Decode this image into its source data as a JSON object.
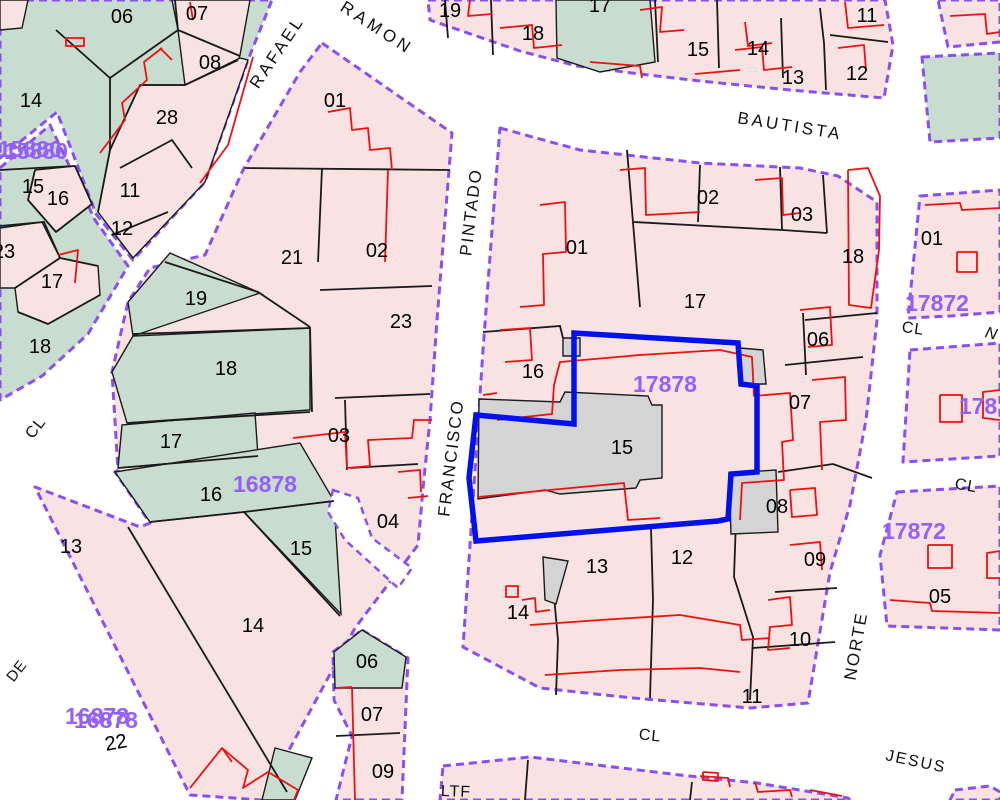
{
  "map": {
    "width": 1000,
    "height": 800,
    "colors": {
      "pink": "#f8e2e2",
      "green": "#c9dcd0",
      "gray": "#d4d4d4",
      "street": "#ffffff",
      "purple": "#8a50ee",
      "label_purple": "#9460fa",
      "red": "#f01010",
      "blue": "#0010ee",
      "black": "#1a1a1a",
      "text": "#000000"
    },
    "blocks": [
      {
        "name": "top-left",
        "fill": "green",
        "pts": "0,0 272,0 248,60 205,182 133,260 96,214 57,112 0,158"
      },
      {
        "name": "left-wedge",
        "fill": "green",
        "pts": "0,168 50,125 95,220 128,266 88,334 42,376 0,400"
      },
      {
        "name": "mega-16878",
        "fill": "pink",
        "pts": "322,43 452,133 445,220 437,320 430,420 424,478 418,545 355,628 262,800 190,795 35,487 140,527 150,523 115,472 118,470 112,372 128,302 150,268 205,255 243,170 300,72"
      },
      {
        "name": "se-strip",
        "fill": "pink",
        "pts": "362,630 408,658 402,800 336,800 352,736 334,700 333,652"
      },
      {
        "name": "central-17878",
        "fill": "pink",
        "pts": "500,128 580,150 700,163 800,168 838,176 877,202 877,320 866,420 850,505 830,572 808,703 750,708 633,698 540,688 463,647 469,560 475,470 483,350 492,230"
      },
      {
        "name": "top-strip",
        "fill": "pink",
        "pts": "428,0 885,0 893,45 884,98 790,90 700,81 640,74 577,66 520,51 430,20"
      },
      {
        "name": "top-right-1",
        "fill": "pink",
        "pts": "938,0 1000,0 1000,42 948,47"
      },
      {
        "name": "top-right-green",
        "fill": "green",
        "pts": "922,57 1000,53 1000,138 930,142"
      },
      {
        "name": "right-mid",
        "fill": "pink",
        "pts": "920,196 1000,190 1000,312 950,316 908,318"
      },
      {
        "name": "right-2",
        "fill": "pink",
        "pts": "910,350 1000,343 1000,456 903,462"
      },
      {
        "name": "right-3",
        "fill": "pink",
        "pts": "897,492 1000,486 1000,630 887,626 880,555"
      },
      {
        "name": "bottom-strip",
        "fill": "pink",
        "pts": "443,766 530,757 680,775 757,783 848,798 850,800 440,800"
      },
      {
        "name": "bottom-right-corner",
        "fill": "pink",
        "pts": "955,790 990,786 1000,792 1000,800 950,800"
      }
    ],
    "green_areas": [
      {
        "name": "strip-17",
        "pts": "556,0 650,0 655,62 600,72 557,58"
      },
      {
        "name": "mega-19",
        "pts": "128,302 170,253 260,293 133,336"
      },
      {
        "name": "mega-18",
        "pts": "112,372 133,336 310,328 310,410 127,423"
      },
      {
        "name": "mega-17",
        "pts": "118,468 122,425 255,413 258,456"
      },
      {
        "name": "mega-16",
        "pts": "115,472 300,443 334,501 244,512 150,522"
      },
      {
        "name": "mega-15",
        "pts": "244,512 334,501 341,614"
      },
      {
        "name": "se-06",
        "pts": "334,652 362,630 406,657 402,688 335,688"
      },
      {
        "name": "mega-sliver",
        "pts": "275,748 312,758 295,800 262,800"
      }
    ],
    "pink_areas": [
      {
        "name": "tl-07-08",
        "pts": "172,0 250,0 240,55 228,93 185,85 178,30"
      },
      {
        "name": "tl-28-11-12",
        "pts": "110,150 140,85 185,85 240,58 248,60 205,182 133,258 98,212"
      },
      {
        "name": "tl-corner",
        "pts": "0,0 28,0 22,28 0,30"
      },
      {
        "name": "lw-16",
        "pts": "35,170 75,166 92,204 56,232 28,200"
      },
      {
        "name": "lw-23",
        "pts": "0,228 42,222 60,258 15,288 0,288"
      },
      {
        "name": "lw-17",
        "pts": "15,288 60,258 98,266 100,295 48,324 18,312"
      }
    ],
    "white_notches": [
      {
        "name": "notch-04",
        "pts": "333,490 358,498 372,538 412,568 398,588 345,540 328,512"
      }
    ],
    "gray_buildings": [
      {
        "name": "bld-15",
        "pts": "479,399 560,402 565,392 648,396 652,405 662,405 662,478 640,480 636,488 560,494 545,490 478,499"
      },
      {
        "name": "bld-small-16",
        "pts": "563,338 580,338 580,356 563,356"
      },
      {
        "name": "bld-ne",
        "pts": "740,348 763,350 766,384 741,384"
      },
      {
        "name": "bld-08",
        "pts": "729,473 776,470 778,532 731,534"
      },
      {
        "name": "bld-13",
        "pts": "543,557 568,561 556,604 545,600"
      }
    ],
    "blue_parcel": "476,415 574,424 574,333 738,343 741,384 757,386 757,472 731,474 728,519 718,521 476,541 469,478",
    "black_lines": [
      "175,0 178,30",
      "56,30 110,78 178,30",
      "110,78 110,150 98,212",
      "178,30 240,56",
      "185,85 238,60",
      "140,85 185,85",
      "110,150 140,85",
      "120,168 172,140 192,168",
      "112,235 168,212",
      "0,170 36,168 75,166",
      "35,170 28,200 56,232",
      "56,232 92,204 75,166",
      "0,226 44,222 60,258",
      "15,288 60,258 98,266",
      "18,312 48,324 100,295",
      "245,168 450,170",
      "322,168 318,262",
      "165,262 258,292 310,327",
      "133,334 310,328",
      "127,423 310,412",
      "118,468 258,456",
      "150,522 244,512 334,501",
      "244,512 340,616",
      "128,527 287,792",
      "320,290 432,286",
      "310,327 312,412",
      "335,398 430,394",
      "345,400 347,470",
      "350,468 418,464",
      "483,332 560,326 563,338",
      "627,150 640,307",
      "634,222 782,230 827,233",
      "780,167 782,230",
      "823,175 827,233",
      "805,320 877,313",
      "803,313 806,375",
      "785,365 863,357",
      "778,472 833,464 872,478",
      "775,592 837,588",
      "736,520 734,577 753,637 750,700",
      "651,528 653,600 650,698",
      "553,585 558,640 556,695",
      "753,648 835,642",
      "700,165 698,222",
      "336,736 400,733",
      "445,0 448,38",
      "491,0 493,55",
      "717,0 719,68",
      "781,18 783,78",
      "820,8 824,43 826,90",
      "830,35 888,42",
      "655,0 658,62",
      "528,760 525,800",
      "692,782 690,800"
    ],
    "red_lines": [
      "540,205 565,202 566,252 543,254 544,305 520,307",
      "620,170 645,168 646,215 700,212",
      "755,180 782,178 783,215 800,213",
      "848,170 868,168 880,196 879,250 871,308 849,305 848,170",
      "800,310 830,307 832,345 808,347",
      "812,380 845,377 846,420 820,422 822,470",
      "497,420 552,414 554,385 560,362 640,355 720,350 752,357 754,396 790,393 793,440 782,442 784,480 742,483 740,520",
      "478,497 560,489 624,483 628,520 660,518",
      "530,625 600,620 680,615 740,625 742,640 770,638",
      "545,675 620,670 700,668 740,672",
      "768,600 790,597 792,625 770,627 768,650 790,648",
      "790,545 820,542 822,570",
      "790,490 815,488 817,515 792,517 790,490",
      "506,586 518,586 518,597 506,597 506,586",
      "522,600 535,598 536,612 550,610",
      "500,330 530,328 532,360 505,362",
      "483,395 497,393",
      "328,112 350,108 352,130 368,128 370,150 390,148 392,170",
      "388,170 385,262",
      "100,153 125,120 122,103 147,80 144,62 162,48",
      "253,57 228,145 200,183",
      "293,438 345,432 347,468 370,466 368,440 412,438 414,420 432,420",
      "398,472 420,470 421,492",
      "408,498 428,496",
      "190,788 222,748 248,770 243,788 268,772 298,790 294,800",
      "222,748 232,762",
      "352,687 355,800",
      "336,688 352,687",
      "58,255 78,250 75,283",
      "66,38 84,38 84,46 66,46 66,38",
      "190,2 193,20",
      "160,48 172,60",
      "470,0 468,16 492,14",
      "500,28 532,25 534,48 562,45",
      "640,10 662,7 660,32 684,30",
      "745,22 748,46 772,43",
      "735,50 762,47 764,70 792,67",
      "838,48 864,45 866,70",
      "845,2 848,28 884,25",
      "590,62 640,66 642,78",
      "695,74 740,70",
      "925,205 960,203 962,210 1000,208",
      "957,252 977,252 977,272 957,272 957,252",
      "950,16 985,14 987,34 1000,32",
      "940,395 962,395 962,422 940,422 940,395",
      "1000,390 983,392 983,418 1000,420",
      "928,545 952,545 952,568 928,568 928,545",
      "1000,551 987,553 987,578 1000,578",
      "890,600 930,603 932,611 1000,613",
      "700,776 728,778 730,787",
      "755,782 758,792 790,790 792,797",
      "810,790 842,796",
      "703,772 718,773 718,781 703,780 703,772"
    ],
    "parcel_labels": [
      {
        "t": "06",
        "x": 122,
        "y": 17
      },
      {
        "t": "07",
        "x": 197,
        "y": 14
      },
      {
        "t": "08",
        "x": 210,
        "y": 63
      },
      {
        "t": "14",
        "x": 31,
        "y": 101
      },
      {
        "t": "28",
        "x": 167,
        "y": 118
      },
      {
        "t": "11",
        "x": 130,
        "y": 191
      },
      {
        "t": "12",
        "x": 122,
        "y": 229
      },
      {
        "t": "15",
        "x": 33,
        "y": 187
      },
      {
        "t": "16",
        "x": 58,
        "y": 199
      },
      {
        "t": "23",
        "x": 4,
        "y": 252
      },
      {
        "t": "17",
        "x": 52,
        "y": 282
      },
      {
        "t": "18",
        "x": 40,
        "y": 347
      },
      {
        "t": "01",
        "x": 335,
        "y": 101
      },
      {
        "t": "21",
        "x": 292,
        "y": 258
      },
      {
        "t": "02",
        "x": 377,
        "y": 251
      },
      {
        "t": "23",
        "x": 401,
        "y": 322
      },
      {
        "t": "19",
        "x": 196,
        "y": 299
      },
      {
        "t": "18",
        "x": 226,
        "y": 369
      },
      {
        "t": "17",
        "x": 171,
        "y": 442
      },
      {
        "t": "16",
        "x": 211,
        "y": 495
      },
      {
        "t": "03",
        "x": 339,
        "y": 436
      },
      {
        "t": "04",
        "x": 388,
        "y": 522
      },
      {
        "t": "15",
        "x": 301,
        "y": 549
      },
      {
        "t": "13",
        "x": 71,
        "y": 547
      },
      {
        "t": "14",
        "x": 253,
        "y": 626
      },
      {
        "t": "22",
        "x": 116,
        "y": 743,
        "rot": -10
      },
      {
        "t": "06",
        "x": 367,
        "y": 662
      },
      {
        "t": "07",
        "x": 372,
        "y": 715
      },
      {
        "t": "09",
        "x": 383,
        "y": 772
      },
      {
        "t": "19",
        "x": 450,
        "y": 11
      },
      {
        "t": "18",
        "x": 533,
        "y": 34
      },
      {
        "t": "17",
        "x": 600,
        "y": 6
      },
      {
        "t": "15",
        "x": 698,
        "y": 50
      },
      {
        "t": "14",
        "x": 758,
        "y": 49
      },
      {
        "t": "13",
        "x": 793,
        "y": 78
      },
      {
        "t": "12",
        "x": 857,
        "y": 74
      },
      {
        "t": "11",
        "x": 867,
        "y": 16
      },
      {
        "t": "01",
        "x": 577,
        "y": 248
      },
      {
        "t": "02",
        "x": 708,
        "y": 198
      },
      {
        "t": "03",
        "x": 802,
        "y": 215
      },
      {
        "t": "18",
        "x": 853,
        "y": 257
      },
      {
        "t": "17",
        "x": 695,
        "y": 302
      },
      {
        "t": "06",
        "x": 818,
        "y": 340
      },
      {
        "t": "07",
        "x": 800,
        "y": 403
      },
      {
        "t": "16",
        "x": 533,
        "y": 372
      },
      {
        "t": "15",
        "x": 622,
        "y": 448
      },
      {
        "t": "08",
        "x": 777,
        "y": 507
      },
      {
        "t": "09",
        "x": 815,
        "y": 560
      },
      {
        "t": "12",
        "x": 682,
        "y": 558
      },
      {
        "t": "13",
        "x": 597,
        "y": 567
      },
      {
        "t": "14",
        "x": 518,
        "y": 613
      },
      {
        "t": "10",
        "x": 800,
        "y": 640
      },
      {
        "t": "11",
        "x": 752,
        "y": 697
      },
      {
        "t": "01",
        "x": 932,
        "y": 239
      },
      {
        "t": "05",
        "x": 940,
        "y": 597
      }
    ],
    "block_labels": [
      {
        "t": "15880",
        "x": 30,
        "y": 149
      },
      {
        "t": "15880",
        "x": 36,
        "y": 151
      },
      {
        "t": "16878",
        "x": 265,
        "y": 484
      },
      {
        "t": "16878",
        "x": 97,
        "y": 716
      },
      {
        "t": "16878",
        "x": 106,
        "y": 720
      },
      {
        "t": "17878",
        "x": 665,
        "y": 384
      },
      {
        "t": "17872",
        "x": 937,
        "y": 303
      },
      {
        "t": "17872",
        "x": 914,
        "y": 531
      },
      {
        "t": "178",
        "x": 978,
        "y": 406
      }
    ],
    "street_labels": [
      {
        "t": "RAFAEL",
        "x": 277,
        "y": 52,
        "rot": -56,
        "ls": 3,
        "fs": 17
      },
      {
        "t": "RAMON",
        "x": 377,
        "y": 28,
        "rot": 33,
        "ls": 4,
        "fs": 17
      },
      {
        "t": "BAUTISTA",
        "x": 790,
        "y": 126,
        "rot": 9,
        "ls": 3,
        "fs": 17
      },
      {
        "t": "PINTADO",
        "x": 471,
        "y": 212,
        "rot": -83,
        "ls": 2,
        "fs": 17
      },
      {
        "t": "FRANCISCO",
        "x": 451,
        "y": 458,
        "rot": -83,
        "ls": 2,
        "fs": 17
      },
      {
        "t": "CL",
        "x": 36,
        "y": 428,
        "rot": -52,
        "ls": 1,
        "fs": 16
      },
      {
        "t": "DE",
        "x": 17,
        "y": 671,
        "rot": -52,
        "ls": 1,
        "fs": 15
      },
      {
        "t": "NORTE",
        "x": 856,
        "y": 646,
        "rot": -80,
        "ls": 2,
        "fs": 17
      },
      {
        "t": "JESUS",
        "x": 916,
        "y": 762,
        "rot": 12,
        "ls": 2,
        "fs": 16
      },
      {
        "t": "CL",
        "x": 650,
        "y": 736,
        "rot": 6,
        "ls": 1,
        "fs": 16
      },
      {
        "t": "CL",
        "x": 913,
        "y": 329,
        "rot": 8,
        "ls": 1,
        "fs": 16
      },
      {
        "t": "CL",
        "x": 966,
        "y": 486,
        "rot": 10,
        "ls": 1,
        "fs": 16
      },
      {
        "t": "LTF",
        "x": 456,
        "y": 792,
        "rot": 2,
        "ls": 1,
        "fs": 16
      },
      {
        "t": "N",
        "x": 991,
        "y": 334,
        "rot": 15,
        "ls": 0,
        "fs": 16,
        "italic": true
      }
    ]
  }
}
